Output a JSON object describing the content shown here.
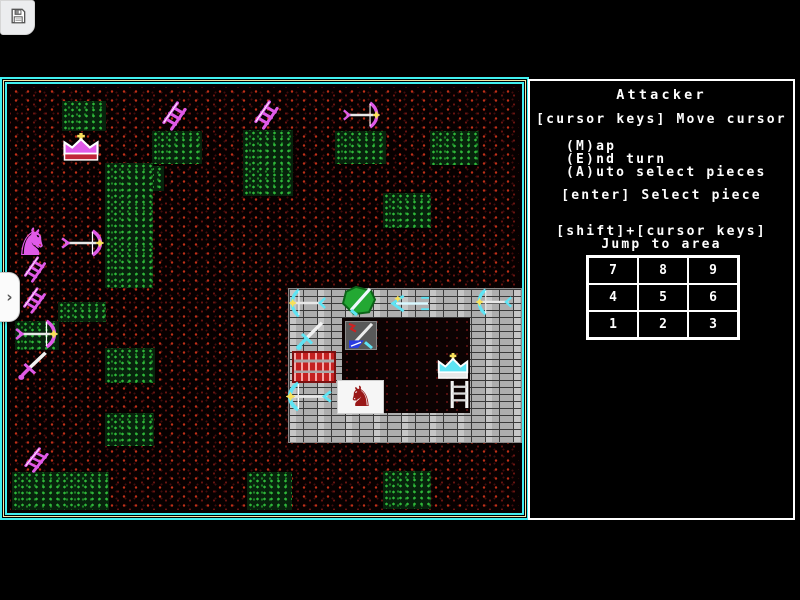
{
  "chrome": {
    "save_button": {
      "icon": "floppy-save-icon"
    },
    "sidebar_toggle": {
      "icon": "chevron-right-icon",
      "glyph": "›"
    }
  },
  "panel": {
    "title": "Attacker",
    "hint_move": "[cursor keys] Move cursor",
    "menu": [
      "(M)ap",
      "(E)nd turn",
      "(A)uto select pieces"
    ],
    "hint_select": "[enter] Select piece",
    "hint_jump_keys": "[shift]+[cursor keys]",
    "hint_jump_label": "Jump to area",
    "grid": {
      "cells": [
        "7",
        "8",
        "9",
        "4",
        "5",
        "6",
        "1",
        "2",
        "3"
      ]
    }
  },
  "colors": {
    "attacker": "#e05ae8",
    "defender": "#5ee4f4",
    "accent_star": "#f8e05a",
    "terrain_red": "#c03018",
    "terrain_green": "#2fb83a",
    "brick_gray": "#c6c6c6",
    "border_cyan": "#41f0f0",
    "border_yellow": "#efe9a8",
    "panel_text": "#ffffff",
    "horse_red": "#991717",
    "blade_white": "#f2f2f2"
  },
  "map": {
    "castle": {
      "x": 283,
      "y": 283,
      "w": 234,
      "h": 155,
      "floor": {
        "x": 337,
        "y": 313,
        "w": 128,
        "h": 95
      }
    },
    "patches": [
      [
        57,
        96,
        44,
        30
      ],
      [
        147,
        126,
        50,
        33
      ],
      [
        130,
        161,
        29,
        25
      ],
      [
        100,
        158,
        48,
        125
      ],
      [
        238,
        125,
        50,
        66
      ],
      [
        330,
        126,
        51,
        33
      ],
      [
        425,
        126,
        49,
        34
      ],
      [
        378,
        188,
        48,
        35
      ],
      [
        53,
        297,
        48,
        20
      ],
      [
        10,
        316,
        44,
        29
      ],
      [
        100,
        343,
        50,
        35
      ],
      [
        100,
        408,
        49,
        33
      ],
      [
        7,
        467,
        97,
        38
      ],
      [
        242,
        467,
        45,
        38
      ],
      [
        378,
        466,
        48,
        38
      ]
    ],
    "pieces": [
      {
        "type": "crown",
        "side": "attacker",
        "x": 54,
        "y": 127,
        "w": 44,
        "h": 31
      },
      {
        "type": "ladder",
        "side": "attacker",
        "x": 154,
        "y": 96,
        "w": 31,
        "h": 30
      },
      {
        "type": "ladder",
        "side": "attacker",
        "x": 246,
        "y": 95,
        "w": 31,
        "h": 30
      },
      {
        "type": "crossbow-right",
        "side": "attacker",
        "x": 337,
        "y": 96,
        "w": 38,
        "h": 28
      },
      {
        "type": "horse-right",
        "side": "attacker",
        "x": 6,
        "y": 218,
        "w": 42,
        "h": 38
      },
      {
        "type": "crossbow-right",
        "side": "attacker",
        "x": 55,
        "y": 224,
        "w": 44,
        "h": 28
      },
      {
        "type": "ladder",
        "side": "attacker",
        "x": 16,
        "y": 251,
        "w": 28,
        "h": 27
      },
      {
        "type": "ladder",
        "side": "attacker",
        "x": 15,
        "y": 282,
        "w": 29,
        "h": 27
      },
      {
        "type": "crossbow-right",
        "side": "attacker",
        "x": 9,
        "y": 314,
        "w": 44,
        "h": 30
      },
      {
        "type": "sword",
        "side": "attacker",
        "x": 11,
        "y": 344,
        "w": 38,
        "h": 32
      },
      {
        "type": "ladder",
        "side": "attacker",
        "x": 16,
        "y": 442,
        "w": 31,
        "h": 26
      },
      {
        "type": "crossbow-left",
        "side": "defender",
        "x": 284,
        "y": 283,
        "w": 38,
        "h": 30
      },
      {
        "type": "shield",
        "side": "defender",
        "x": 334,
        "y": 280,
        "w": 40,
        "h": 33
      },
      {
        "type": "arrow-left",
        "side": "defender",
        "x": 382,
        "y": 289,
        "w": 45,
        "h": 19
      },
      {
        "type": "crossbow-left",
        "side": "defender",
        "x": 471,
        "y": 283,
        "w": 37,
        "h": 28
      },
      {
        "type": "sword",
        "side": "defender",
        "x": 289,
        "y": 314,
        "w": 36,
        "h": 32
      },
      {
        "type": "armory",
        "side": "defender",
        "x": 340,
        "y": 316,
        "w": 32,
        "h": 29
      },
      {
        "type": "gate",
        "side": "defender",
        "x": 287,
        "y": 346,
        "w": 44,
        "h": 32
      },
      {
        "type": "crown",
        "side": "defender",
        "x": 429,
        "y": 347,
        "w": 38,
        "h": 29
      },
      {
        "type": "ladder-white",
        "side": "defender",
        "x": 442,
        "y": 375,
        "w": 25,
        "h": 29
      },
      {
        "type": "crossbow-left",
        "side": "defender",
        "x": 281,
        "y": 376,
        "w": 47,
        "h": 31
      },
      {
        "type": "horse-tile",
        "side": "defender",
        "x": 332,
        "y": 375,
        "w": 47,
        "h": 34
      }
    ]
  }
}
